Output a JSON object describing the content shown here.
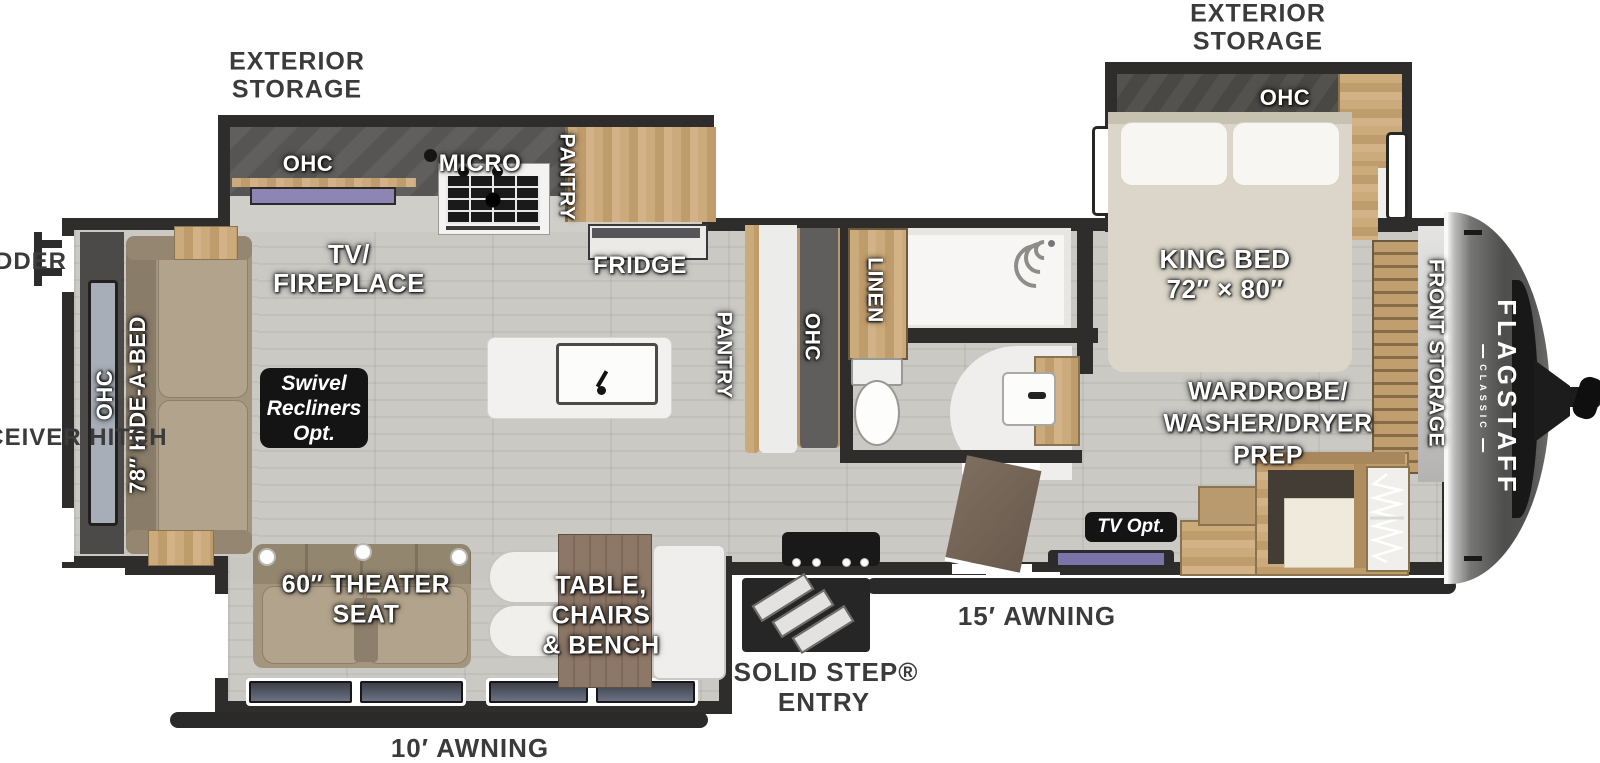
{
  "brand": {
    "name": "FLAGSTAFF",
    "series": "CLASSIC"
  },
  "exterior": {
    "storage_left": {
      "line1": "EXTERIOR",
      "line2": "STORAGE"
    },
    "storage_right": {
      "line1": "EXTERIOR",
      "line2": "STORAGE"
    },
    "ladder": "LADDER",
    "receiver_hitch": "2″ RECEIVER HITCH",
    "solid_step": {
      "line1": "SOLID STEP®",
      "line2": "ENTRY"
    },
    "awning_rear": "10′ AWNING",
    "awning_front": "15′ AWNING"
  },
  "living": {
    "ohc_rear": "OHC",
    "hide_a_bed": "78″ HIDE-A-BED",
    "tv_fireplace": {
      "line1": "TV/",
      "line2": "FIREPLACE"
    },
    "swivel_badge": {
      "line1": "Swivel",
      "line2": "Recliners",
      "line3": "Opt."
    },
    "theater_seat": {
      "line1": "60″ THEATER",
      "line2": "SEAT"
    },
    "dinette": {
      "line1": "TABLE,",
      "line2": "CHAIRS",
      "line3": "& BENCH"
    }
  },
  "kitchen": {
    "ohc": "OHC",
    "micro": "MICRO",
    "pantry_wall": "PANTRY",
    "fridge": "FRIDGE",
    "pantry_island": "PANTRY",
    "ohc_island": "OHC"
  },
  "bath": {
    "linen": "LINEN"
  },
  "bedroom": {
    "ohc": "OHC",
    "king_bed": {
      "line1": "KING BED",
      "line2": "72″ × 80″"
    },
    "wardrobe": {
      "line1": "WARDROBE/",
      "line2": "WASHER/DRYER",
      "line3": "PREP"
    },
    "tv_opt": "TV Opt.",
    "front_storage": "FRONT STORAGE"
  },
  "colors": {
    "wall": "#2e2d2c",
    "floor": "#c9c8c3",
    "wood": "#c6a473",
    "counter_dark": "#5f5e5c",
    "badge": "#141414",
    "sofa": "#a4967e",
    "front_cap": "#4e4e4d",
    "label_text": "#ffffff",
    "exterior_text": "#3b3b3b",
    "accent_window": "#8d86b5"
  }
}
